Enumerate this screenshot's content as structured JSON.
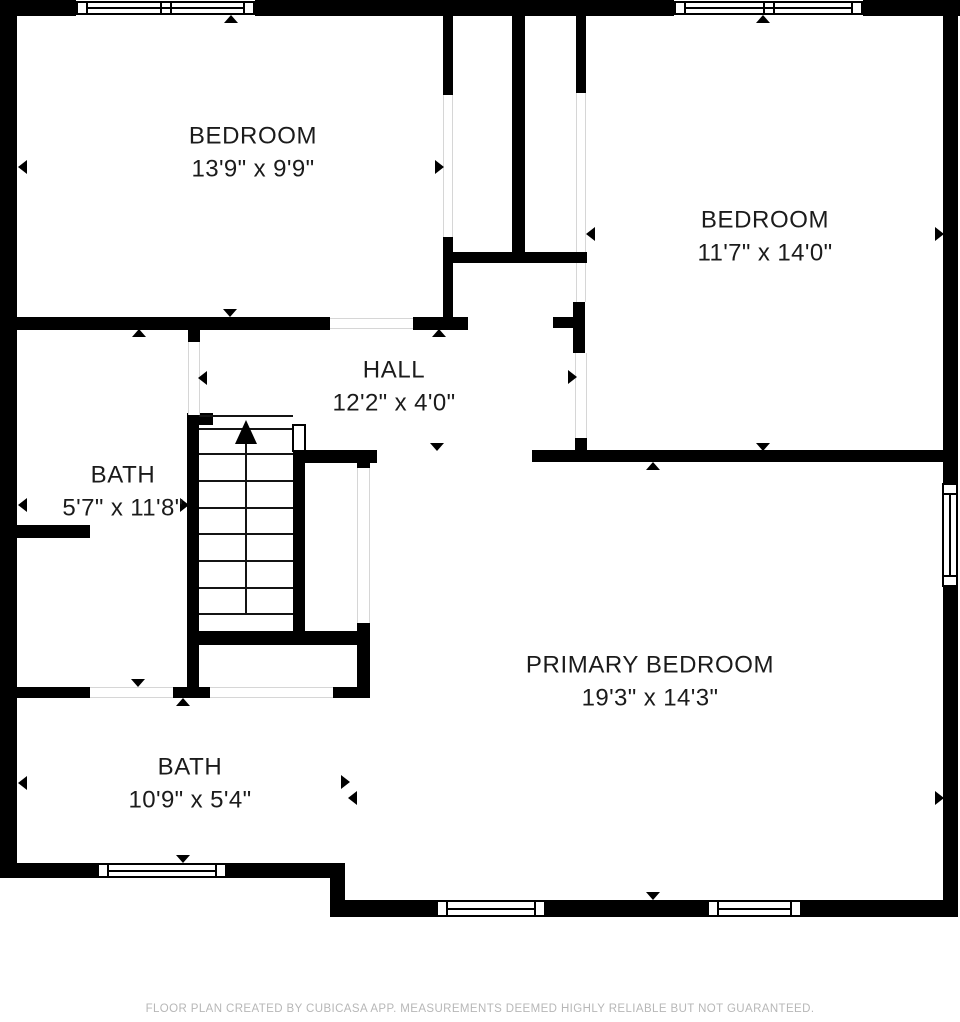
{
  "plan": {
    "footer_text": "FLOOR PLAN CREATED BY CUBICASA APP. MEASUREMENTS DEEMED HIGHLY RELIABLE BUT NOT GUARANTEED.",
    "rooms": [
      {
        "name": "BEDROOM",
        "dims": "13'9\" x 9'9\"",
        "cx": 253,
        "cy": 153
      },
      {
        "name": "BEDROOM",
        "dims": "11'7\" x 14'0\"",
        "cx": 765,
        "cy": 237
      },
      {
        "name": "HALL",
        "dims": "12'2\" x 4'0\"",
        "cx": 394,
        "cy": 387
      },
      {
        "name": "BATH",
        "dims": "5'7\" x 11'8\"",
        "cx": 123,
        "cy": 492
      },
      {
        "name": "PRIMARY BEDROOM",
        "dims": "19'3\" x 14'3\"",
        "cx": 650,
        "cy": 682
      },
      {
        "name": "BATH",
        "dims": "10'9\" x 5'4\"",
        "cx": 190,
        "cy": 784
      }
    ],
    "colors": {
      "wall": "#000000",
      "label": "#1b1b1b",
      "footer_text_color": "#b7b7b7",
      "door_jamb": "#d6d6d6",
      "background": "#ffffff"
    }
  },
  "geometry": {
    "walls": [
      [
        0,
        0,
        76,
        16
      ],
      [
        255,
        0,
        419,
        16
      ],
      [
        863,
        0,
        97,
        16
      ],
      [
        0,
        0,
        17,
        878
      ],
      [
        943,
        0,
        15,
        483
      ],
      [
        943,
        587,
        15,
        330
      ],
      [
        0,
        863,
        97,
        15
      ],
      [
        227,
        863,
        118,
        15
      ],
      [
        330,
        863,
        15,
        54
      ],
      [
        333,
        900,
        103,
        17
      ],
      [
        546,
        900,
        161,
        17
      ],
      [
        802,
        900,
        156,
        17
      ],
      [
        443,
        16,
        10,
        79
      ],
      [
        512,
        16,
        13,
        236
      ],
      [
        576,
        16,
        10,
        77
      ],
      [
        443,
        252,
        144,
        11
      ],
      [
        443,
        237,
        10,
        93
      ],
      [
        17,
        317,
        313,
        13
      ],
      [
        413,
        317,
        55,
        13
      ],
      [
        188,
        328,
        12,
        14
      ],
      [
        553,
        317,
        20,
        11
      ],
      [
        573,
        302,
        12,
        51
      ],
      [
        575,
        438,
        12,
        14
      ],
      [
        532,
        450,
        411,
        12
      ],
      [
        293,
        450,
        84,
        13
      ],
      [
        357,
        463,
        13,
        6
      ],
      [
        187,
        415,
        12,
        283
      ],
      [
        187,
        413,
        26,
        12
      ],
      [
        293,
        463,
        12,
        170
      ],
      [
        187,
        631,
        170,
        14
      ],
      [
        357,
        623,
        13,
        75
      ],
      [
        333,
        687,
        37,
        11
      ],
      [
        17,
        525,
        73,
        13
      ],
      [
        17,
        687,
        73,
        11
      ],
      [
        173,
        687,
        37,
        11
      ]
    ],
    "windows": [
      {
        "x": 76,
        "y": 1,
        "w": 179,
        "h": 14,
        "o": "h",
        "m": true
      },
      {
        "x": 674,
        "y": 1,
        "w": 189,
        "h": 14,
        "o": "h",
        "m": true
      },
      {
        "x": 942,
        "y": 483,
        "w": 16,
        "h": 104,
        "o": "v",
        "m": false
      },
      {
        "x": 97,
        "y": 863,
        "w": 130,
        "h": 15,
        "o": "h",
        "m": false
      },
      {
        "x": 436,
        "y": 900,
        "w": 110,
        "h": 17,
        "o": "h",
        "m": false
      },
      {
        "x": 707,
        "y": 900,
        "w": 95,
        "h": 17,
        "o": "h",
        "m": false
      }
    ],
    "door_gaps": [
      {
        "x": 443,
        "y": 95,
        "w": 10,
        "h": 142,
        "o": "v"
      },
      {
        "x": 576,
        "y": 93,
        "w": 10,
        "h": 159,
        "o": "v"
      },
      {
        "x": 576,
        "y": 263,
        "w": 10,
        "h": 39,
        "o": "v"
      },
      {
        "x": 575,
        "y": 353,
        "w": 12,
        "h": 85,
        "o": "v"
      },
      {
        "x": 188,
        "y": 342,
        "w": 12,
        "h": 73,
        "o": "v"
      },
      {
        "x": 357,
        "y": 468,
        "w": 13,
        "h": 155,
        "o": "v"
      },
      {
        "x": 330,
        "y": 318,
        "w": 83,
        "h": 11,
        "o": "h"
      },
      {
        "x": 90,
        "y": 687,
        "w": 83,
        "h": 11,
        "o": "h"
      },
      {
        "x": 210,
        "y": 687,
        "w": 123,
        "h": 11,
        "o": "h"
      }
    ],
    "triangles": [
      [
        231,
        19,
        "up"
      ],
      [
        763,
        19,
        "up"
      ],
      [
        22,
        167,
        "left"
      ],
      [
        440,
        167,
        "right"
      ],
      [
        590,
        234,
        "left"
      ],
      [
        940,
        234,
        "right"
      ],
      [
        230,
        313,
        "down"
      ],
      [
        139,
        333,
        "up"
      ],
      [
        439,
        333,
        "up"
      ],
      [
        202,
        378,
        "left"
      ],
      [
        573,
        377,
        "right"
      ],
      [
        22,
        505,
        "left"
      ],
      [
        185,
        505,
        "right"
      ],
      [
        437,
        447,
        "down"
      ],
      [
        763,
        447,
        "down"
      ],
      [
        653,
        466,
        "up"
      ],
      [
        138,
        683,
        "down"
      ],
      [
        183,
        702,
        "up"
      ],
      [
        22,
        783,
        "left"
      ],
      [
        346,
        782,
        "right"
      ],
      [
        352,
        798,
        "left"
      ],
      [
        940,
        798,
        "right"
      ],
      [
        183,
        859,
        "down"
      ],
      [
        653,
        896,
        "down"
      ]
    ],
    "stairs": {
      "x": 199,
      "y": 415,
      "w": 94,
      "treads": [
        428,
        453,
        480,
        507,
        533,
        560,
        587,
        613
      ],
      "center_x": 246,
      "arrow_tip": 420,
      "arrow_base": 444,
      "stem_bottom": 613,
      "door": {
        "x": 292,
        "y": 424,
        "w": 14,
        "h": 28
      }
    }
  }
}
